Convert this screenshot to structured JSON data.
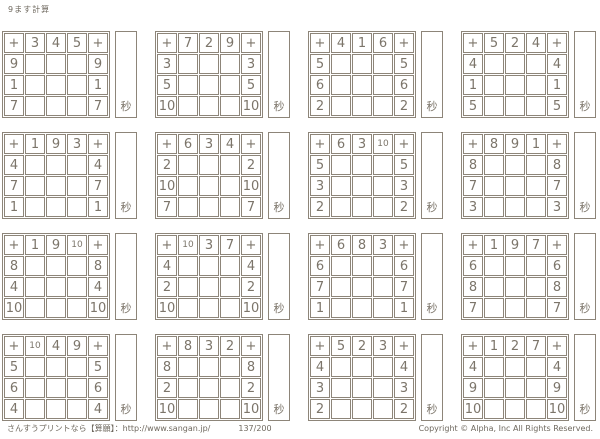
{
  "page": {
    "title": "9ます計算",
    "seconds_label": "秒",
    "footer": {
      "left": "さんすうプリントなら【算願】：http://www.sangan.jp/",
      "center": "137/200",
      "right": "Copyright © Alpha, Inc All Rights Reserved."
    }
  },
  "colors": {
    "background": "#ffffff",
    "grid_border": "#8d8579",
    "digit_text": "#7c756a"
  },
  "puzzles": [
    {
      "operator": "+",
      "col_headers": [
        "3",
        "4",
        "5"
      ],
      "row_headers": [
        "9",
        "1",
        "7"
      ]
    },
    {
      "operator": "+",
      "col_headers": [
        "7",
        "2",
        "9"
      ],
      "row_headers": [
        "3",
        "5",
        "10"
      ]
    },
    {
      "operator": "+",
      "col_headers": [
        "4",
        "1",
        "6"
      ],
      "row_headers": [
        "5",
        "6",
        "2"
      ]
    },
    {
      "operator": "+",
      "col_headers": [
        "5",
        "2",
        "4"
      ],
      "row_headers": [
        "4",
        "1",
        "5"
      ]
    },
    {
      "operator": "+",
      "col_headers": [
        "1",
        "9",
        "3"
      ],
      "row_headers": [
        "4",
        "7",
        "1"
      ]
    },
    {
      "operator": "+",
      "col_headers": [
        "6",
        "3",
        "4"
      ],
      "row_headers": [
        "2",
        "10",
        "7"
      ]
    },
    {
      "operator": "+",
      "col_headers": [
        "6",
        "3",
        "10"
      ],
      "row_headers": [
        "5",
        "3",
        "2"
      ]
    },
    {
      "operator": "+",
      "col_headers": [
        "8",
        "9",
        "1"
      ],
      "row_headers": [
        "8",
        "7",
        "3"
      ]
    },
    {
      "operator": "+",
      "col_headers": [
        "1",
        "9",
        "10"
      ],
      "row_headers": [
        "8",
        "4",
        "10"
      ]
    },
    {
      "operator": "+",
      "col_headers": [
        "10",
        "3",
        "7"
      ],
      "row_headers": [
        "4",
        "2",
        "10"
      ]
    },
    {
      "operator": "+",
      "col_headers": [
        "6",
        "8",
        "3"
      ],
      "row_headers": [
        "6",
        "7",
        "1"
      ]
    },
    {
      "operator": "+",
      "col_headers": [
        "1",
        "9",
        "7"
      ],
      "row_headers": [
        "6",
        "8",
        "7"
      ]
    },
    {
      "operator": "+",
      "col_headers": [
        "10",
        "4",
        "9"
      ],
      "row_headers": [
        "5",
        "6",
        "4"
      ]
    },
    {
      "operator": "+",
      "col_headers": [
        "8",
        "3",
        "2"
      ],
      "row_headers": [
        "8",
        "2",
        "10"
      ]
    },
    {
      "operator": "+",
      "col_headers": [
        "5",
        "2",
        "3"
      ],
      "row_headers": [
        "4",
        "3",
        "2"
      ]
    },
    {
      "operator": "+",
      "col_headers": [
        "1",
        "2",
        "7"
      ],
      "row_headers": [
        "4",
        "9",
        "10"
      ]
    }
  ]
}
